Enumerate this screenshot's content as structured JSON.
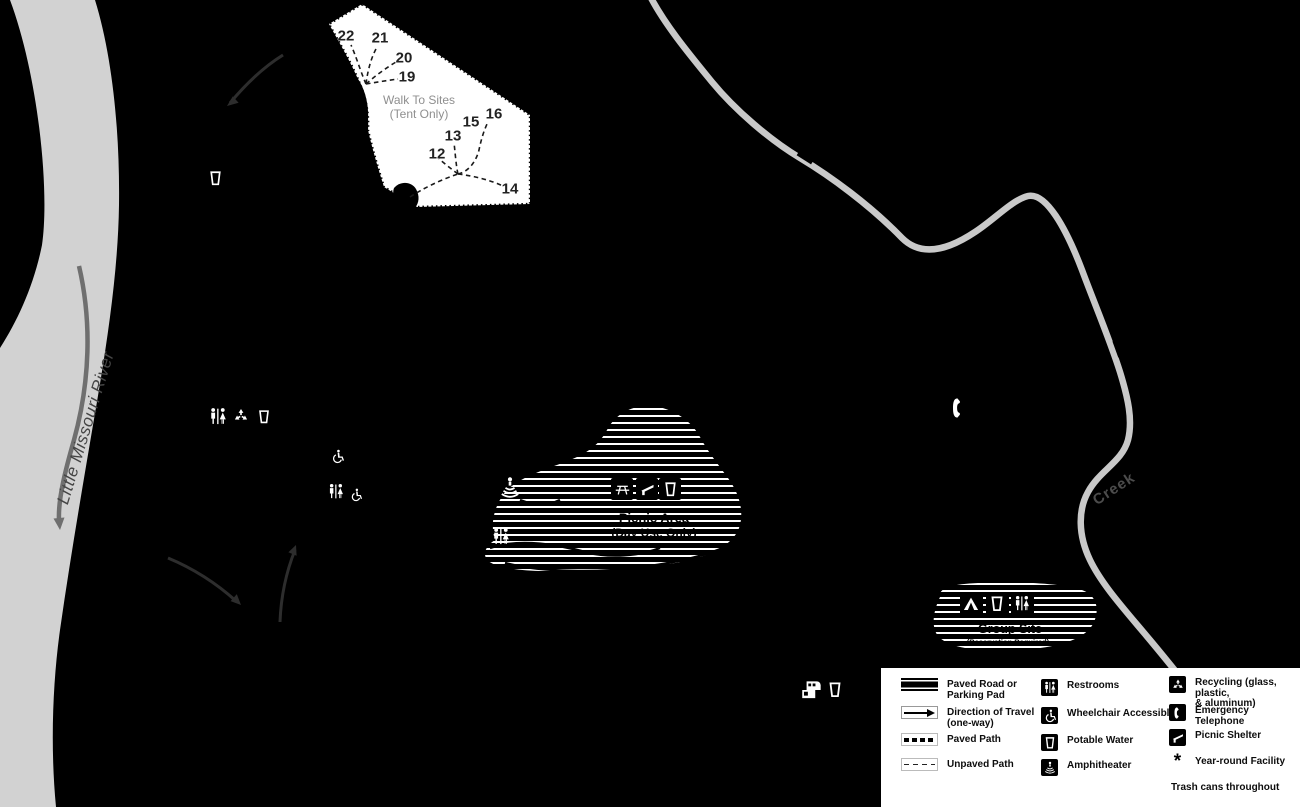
{
  "map": {
    "labels": {
      "river": "Little Missouri River",
      "creek": "Creek",
      "walk_to_sites_line1": "Walk To Sites",
      "walk_to_sites_line2": "(Tent Only)",
      "picnic_area_line1": "Picnic Area",
      "picnic_area_line2": "(Day Use Only)",
      "group_site_line1": "Group Site",
      "group_site_line2": "(Reservation Required)"
    },
    "walk_to_site_numbers": [
      {
        "label": "22",
        "x": 346,
        "y": 36
      },
      {
        "label": "21",
        "x": 380,
        "y": 38
      },
      {
        "label": "20",
        "x": 404,
        "y": 58
      },
      {
        "label": "19",
        "x": 407,
        "y": 77
      },
      {
        "label": "12",
        "x": 437,
        "y": 154
      },
      {
        "label": "13",
        "x": 453,
        "y": 136
      },
      {
        "label": "15",
        "x": 471,
        "y": 122
      },
      {
        "label": "16",
        "x": 494,
        "y": 114
      },
      {
        "label": "14",
        "x": 510,
        "y": 189
      }
    ],
    "icons": [
      {
        "name": "potable-water-icon",
        "x": 215,
        "y": 178,
        "size": 17
      },
      {
        "name": "restrooms-icon",
        "x": 218,
        "y": 417,
        "size": 20
      },
      {
        "name": "recycling-icon",
        "x": 241,
        "y": 416,
        "size": 18
      },
      {
        "name": "potable-water-icon",
        "x": 264,
        "y": 417,
        "size": 16
      },
      {
        "name": "wheelchair-accessible-icon",
        "x": 337,
        "y": 456,
        "size": 15
      },
      {
        "name": "restrooms-icon",
        "x": 336,
        "y": 492,
        "size": 18
      },
      {
        "name": "wheelchair-accessible-icon",
        "x": 356,
        "y": 495,
        "size": 14
      },
      {
        "name": "amphitheater-icon",
        "x": 510,
        "y": 488,
        "size": 24
      },
      {
        "name": "restrooms-icon",
        "x": 501,
        "y": 537,
        "size": 20
      },
      {
        "name": "emergency-telephone-icon",
        "x": 959,
        "y": 408,
        "size": 24
      },
      {
        "name": "dump-station-icon",
        "x": 812,
        "y": 690,
        "size": 26
      },
      {
        "name": "potable-water-icon",
        "x": 835,
        "y": 690,
        "size": 18
      },
      {
        "name": "picnic-table-icon",
        "x": 622,
        "y": 489,
        "size": 22,
        "boxed": true
      },
      {
        "name": "picnic-shelter-icon",
        "x": 647,
        "y": 489,
        "size": 22,
        "boxed": true
      },
      {
        "name": "potable-water-icon",
        "x": 670,
        "y": 489,
        "size": 22,
        "boxed": true
      },
      {
        "name": "tent-icon",
        "x": 971,
        "y": 604,
        "size": 23,
        "boxed": true
      },
      {
        "name": "potable-water-icon",
        "x": 997,
        "y": 604,
        "size": 23,
        "boxed": true
      },
      {
        "name": "restrooms-icon",
        "x": 1022,
        "y": 604,
        "size": 23,
        "boxed": true
      }
    ]
  },
  "legend": {
    "line_items": [
      {
        "symbol": "paved-road",
        "label": "Paved Road or\nParking Pad"
      },
      {
        "symbol": "direction",
        "label": "Direction of Travel\n(one-way)"
      },
      {
        "symbol": "paved-path",
        "label": "Paved Path"
      },
      {
        "symbol": "unpaved-path",
        "label": "Unpaved Path"
      }
    ],
    "facility_items": [
      {
        "icon": "restrooms-icon",
        "label": "Restrooms"
      },
      {
        "icon": "wheelchair-accessible-icon",
        "label": "Wheelchair Accessible"
      },
      {
        "icon": "potable-water-icon",
        "label": "Potable Water"
      },
      {
        "icon": "amphitheater-icon",
        "label": "Amphitheater"
      }
    ],
    "extra_items": [
      {
        "icon": "recycling-icon",
        "label": "Recycling (glass, plastic,\n& aluminum)"
      },
      {
        "icon": "emergency-telephone-icon",
        "label": "Emergency Telephone"
      },
      {
        "icon": "picnic-shelter-icon",
        "label": "Picnic Shelter"
      },
      {
        "icon": "asterisk-icon",
        "char": "*",
        "label": "Year-round Facility"
      }
    ],
    "footnote": "Trash cans throughout"
  },
  "colors": {
    "background": "#000000",
    "river": "#d2d2d2",
    "river_label": "#454545",
    "flow_arrow": "#6f6f6f",
    "creek": "#c9c9c9",
    "creek_label": "#4c4c4c",
    "walk_area": "#ffffff",
    "walk_area_text": "#8f8f8f",
    "travel_arrow": "#2d2d2d",
    "hatch_stripe": "#ffffff",
    "legend_bg": "#ffffff",
    "legend_text": "#0d0d0d"
  }
}
